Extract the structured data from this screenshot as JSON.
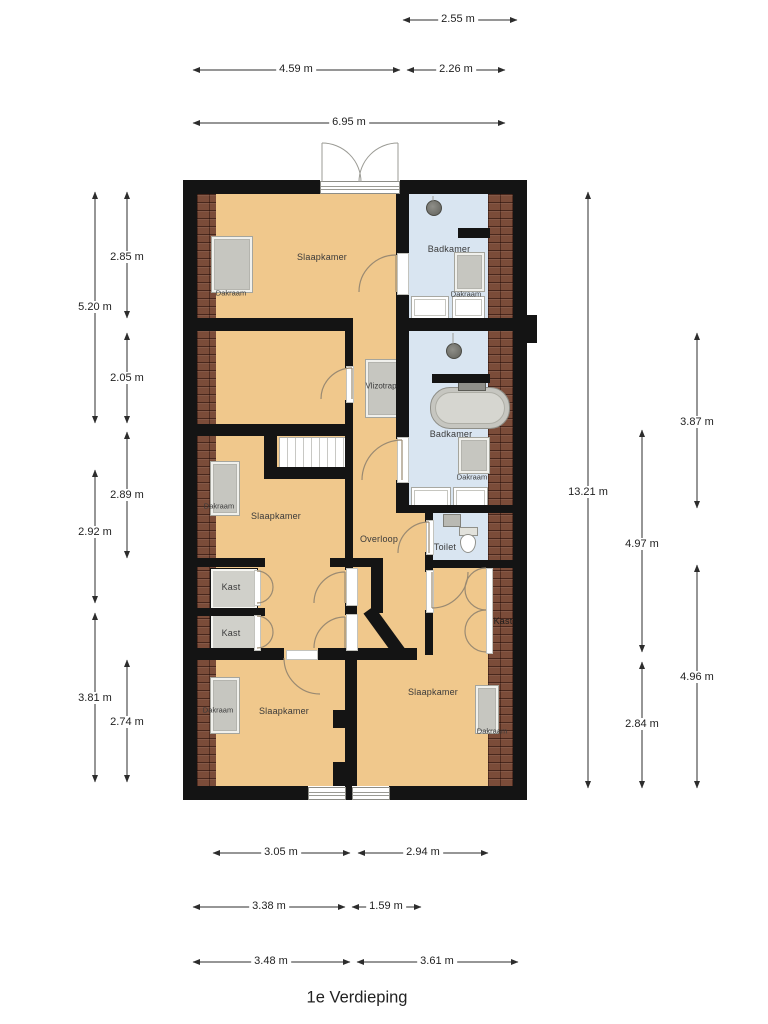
{
  "title": "1e Verdieping",
  "room_labels": {
    "slaapkamer": "Slaapkamer",
    "badkamer": "Badkamer",
    "overloop": "Overloop",
    "toilet": "Toilet",
    "kast": "Kast",
    "vlizotrap": "Vlizotrap",
    "dakraam": "Dakraam"
  },
  "dimensions": {
    "top": [
      "2.55 m",
      "4.59 m",
      "2.26 m",
      "6.95 m"
    ],
    "left": [
      "2.85 m",
      "5.20 m",
      "2.05 m",
      "2.89 m",
      "2.92 m",
      "3.81 m",
      "2.74 m"
    ],
    "right": [
      "13.21 m",
      "3.87 m",
      "4.97 m",
      "4.96 m",
      "2.84 m"
    ],
    "bottom": [
      "3.05 m",
      "2.94 m",
      "3.38 m",
      "1.59 m",
      "3.48 m",
      "3.61 m"
    ]
  },
  "colors": {
    "floor": "#f0c88c",
    "wet_room": "#d9e5f1",
    "wall": "#141414",
    "roof_tiles": "#7b4c39",
    "closet": "#d0d0ca",
    "fixture_gray": "#c6c6c0"
  }
}
